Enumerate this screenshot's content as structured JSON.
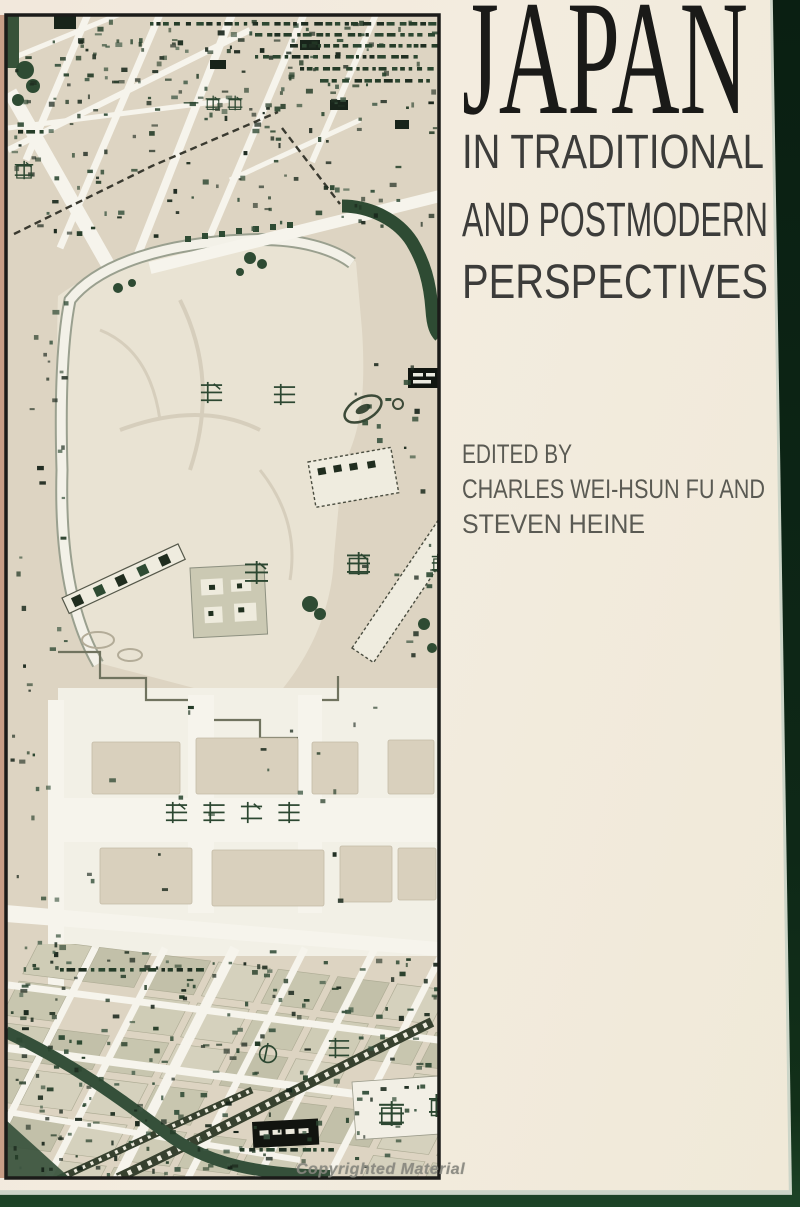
{
  "book_cover": {
    "title": "JAPAN",
    "subtitle_lines": [
      "IN TRADITIONAL",
      "AND POSTMODERN",
      "PERSPECTIVES"
    ],
    "credits": {
      "edited_by": "EDITED BY",
      "editors_line_1": "CHARLES WEI-HSUN FU AND",
      "editors_line_2": "STEVEN HEINE"
    },
    "watermark": "Copyrighted Material"
  },
  "map": {
    "labels": {
      "ichibancho": "一番町",
      "machi": "町",
      "kokyo_1": "皇",
      "kokyo_2": "居",
      "chiyoda_1": "千",
      "chiyoda_2": "代",
      "hibiya_edge": "日",
      "kokyogaien": "皇居外苑",
      "marunouchi_1": "の",
      "marunouchi_2": "内",
      "tokyo_1": "東",
      "tokyo_2": "京"
    }
  },
  "colors": {
    "background_green": "#0e2817",
    "cover_cream": "#f2ebdf",
    "map_tan": "#ddd4c2",
    "palace_cream": "#e9e3d3",
    "garden_white": "#f2f0e6",
    "street_white": "#f6f4ec",
    "moat_green": "#2e4b33",
    "ink_green": "#2c4731",
    "olive_block": "#c8c6af",
    "frame_black": "#1b1b19",
    "spine_salmon": "#c89e87",
    "title_ink": "#1a1a18"
  }
}
